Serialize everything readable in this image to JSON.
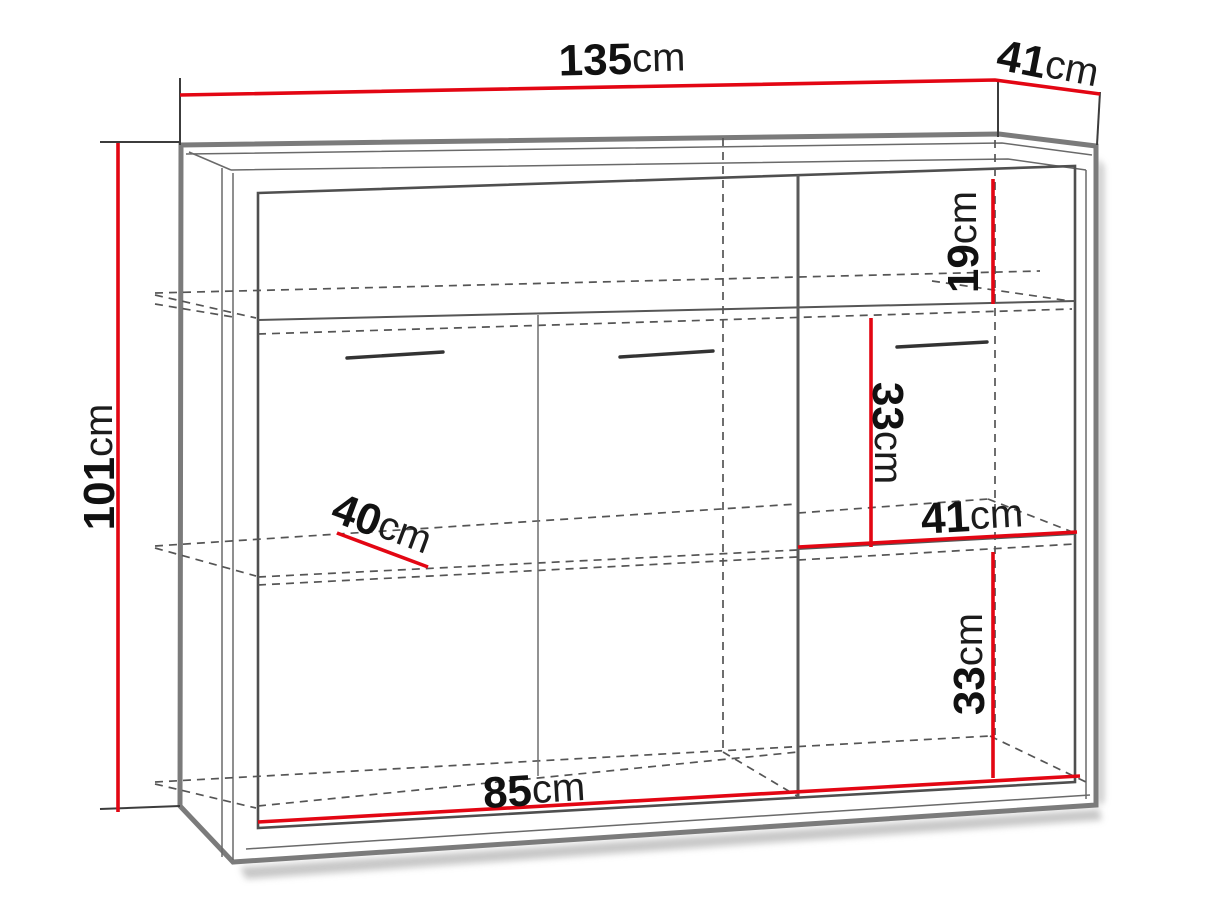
{
  "diagram": {
    "title": "cabinet-dimension-diagram",
    "unit": "cm",
    "dimensions": {
      "overall_width": {
        "value": "135",
        "unit": "cm"
      },
      "overall_depth": {
        "value": "41",
        "unit": "cm"
      },
      "overall_height": {
        "value": "101",
        "unit": "cm"
      },
      "top_compartment_height": {
        "value": "19",
        "unit": "cm"
      },
      "middle_compartment_height": {
        "value": "33",
        "unit": "cm"
      },
      "right_shelf_width": {
        "value": "41",
        "unit": "cm"
      },
      "bottom_compartment_height": {
        "value": "33",
        "unit": "cm"
      },
      "left_shelf_depth": {
        "value": "40",
        "unit": "cm"
      },
      "interior_width": {
        "value": "85",
        "unit": "cm"
      }
    },
    "colors": {
      "dimension_red": "#e30613",
      "frame_gray": "#7b7b7b",
      "line_gray": "#555555",
      "text_black": "#111111",
      "background": "#ffffff"
    }
  }
}
